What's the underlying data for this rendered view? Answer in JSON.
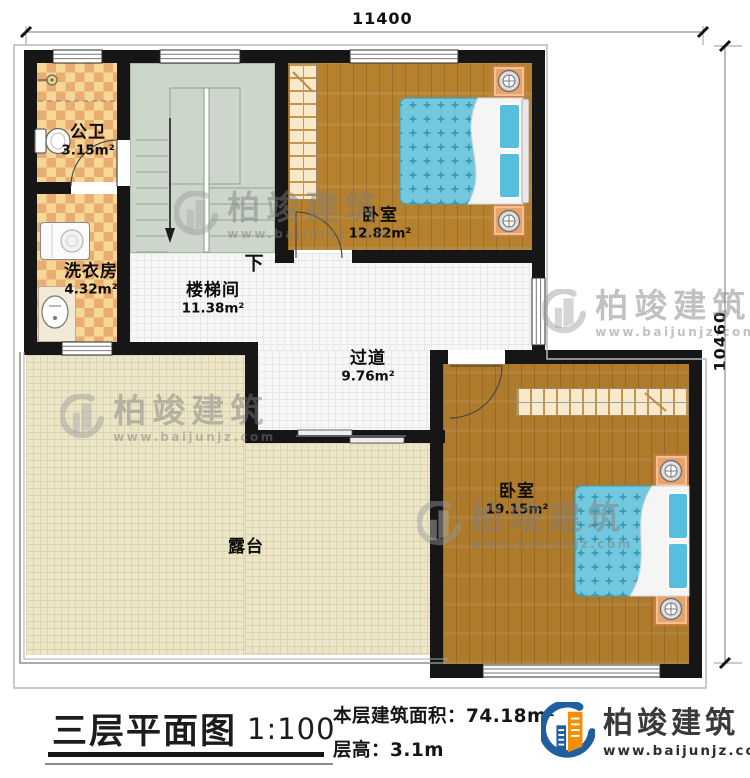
{
  "dims": {
    "top": "11400",
    "right": "10460"
  },
  "rooms": {
    "bathroom": {
      "name": "公卫",
      "area": "3.15m²"
    },
    "laundry": {
      "name": "洗衣房",
      "area": "4.32m²"
    },
    "stairwell": {
      "name": "楼梯间",
      "area": "11.38m²"
    },
    "bedroom_top": {
      "name": "卧室",
      "area": "12.82m²"
    },
    "corridor": {
      "name": "过道",
      "area": "9.76m²"
    },
    "bedroom_right": {
      "name": "卧室",
      "area": "19.15m²"
    },
    "terrace": {
      "name": "露台"
    }
  },
  "stairs": {
    "down_label": "下"
  },
  "legend": {
    "title": "三层平面图",
    "scale": "1:100",
    "area_label": "本层建筑面积：",
    "area_value": "74.18m²",
    "height_label": "层高：",
    "height_value": "3.1m"
  },
  "brand": {
    "name": "柏竣建筑",
    "url": "www.baijunjz.com"
  },
  "watermark": {
    "name": "柏竣建筑",
    "url": "www.baijunjz.com"
  },
  "colors": {
    "wall": "#161616",
    "wood": "#b5812f",
    "bed": "#74c8de",
    "terrace": "#ece5c8",
    "stair": "#cdd6ca",
    "tile_light": "#f6d795",
    "tile_dark": "#e9ad72",
    "brand_blue": "#1f5fa0",
    "brand_orange": "#f28f06"
  }
}
